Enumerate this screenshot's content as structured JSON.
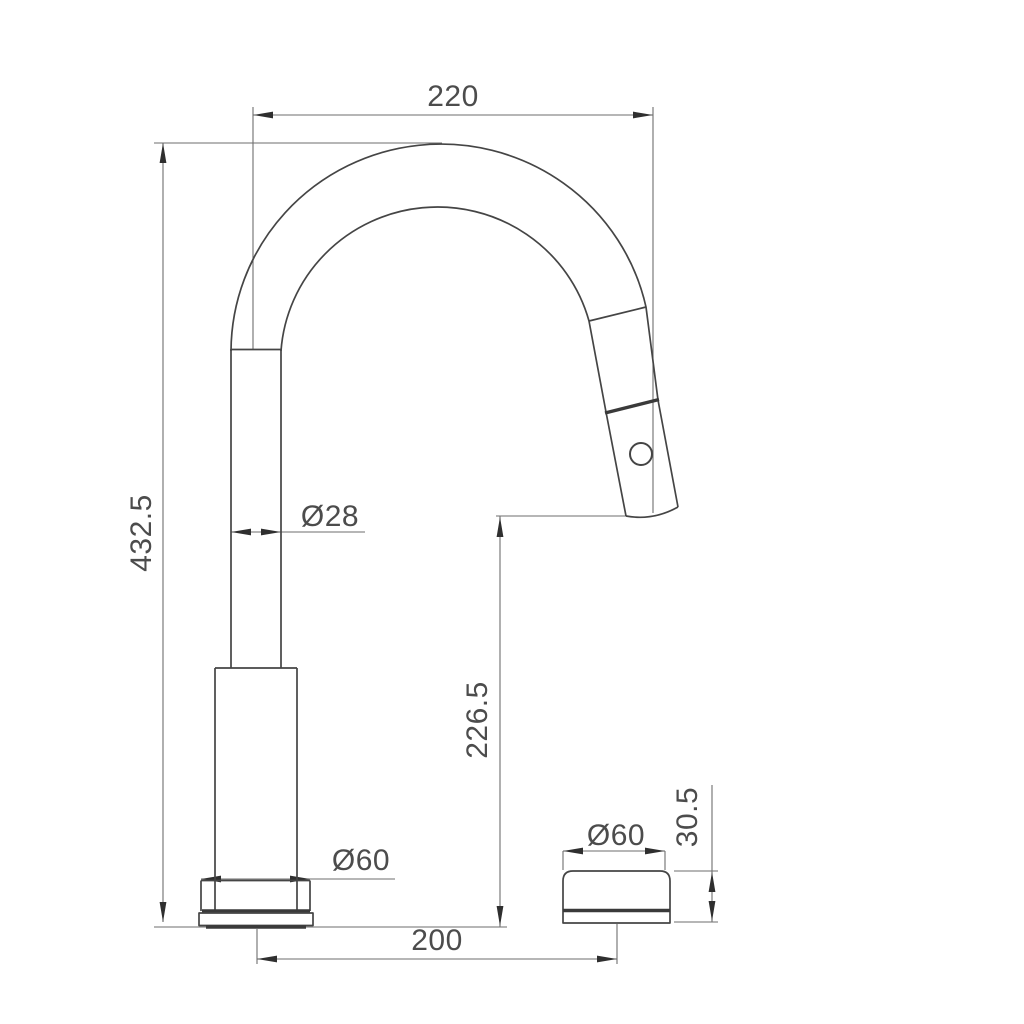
{
  "drawing": {
    "kind": "technical-dimension-drawing",
    "colors": {
      "background": "#ffffff",
      "object_line": "#454545",
      "dimension_line": "#6e6e6e",
      "arrowhead": "#2f2f2f",
      "text": "#4c4c4c"
    },
    "dimensions": {
      "spout_reach": "220",
      "overall_height": "432.5",
      "spout_tube_diameter": "Ø28",
      "outlet_height": "226.5",
      "base_diameter": "Ø60",
      "knob_diameter": "Ø60",
      "knob_height": "30.5",
      "centre_distance": "200"
    }
  }
}
